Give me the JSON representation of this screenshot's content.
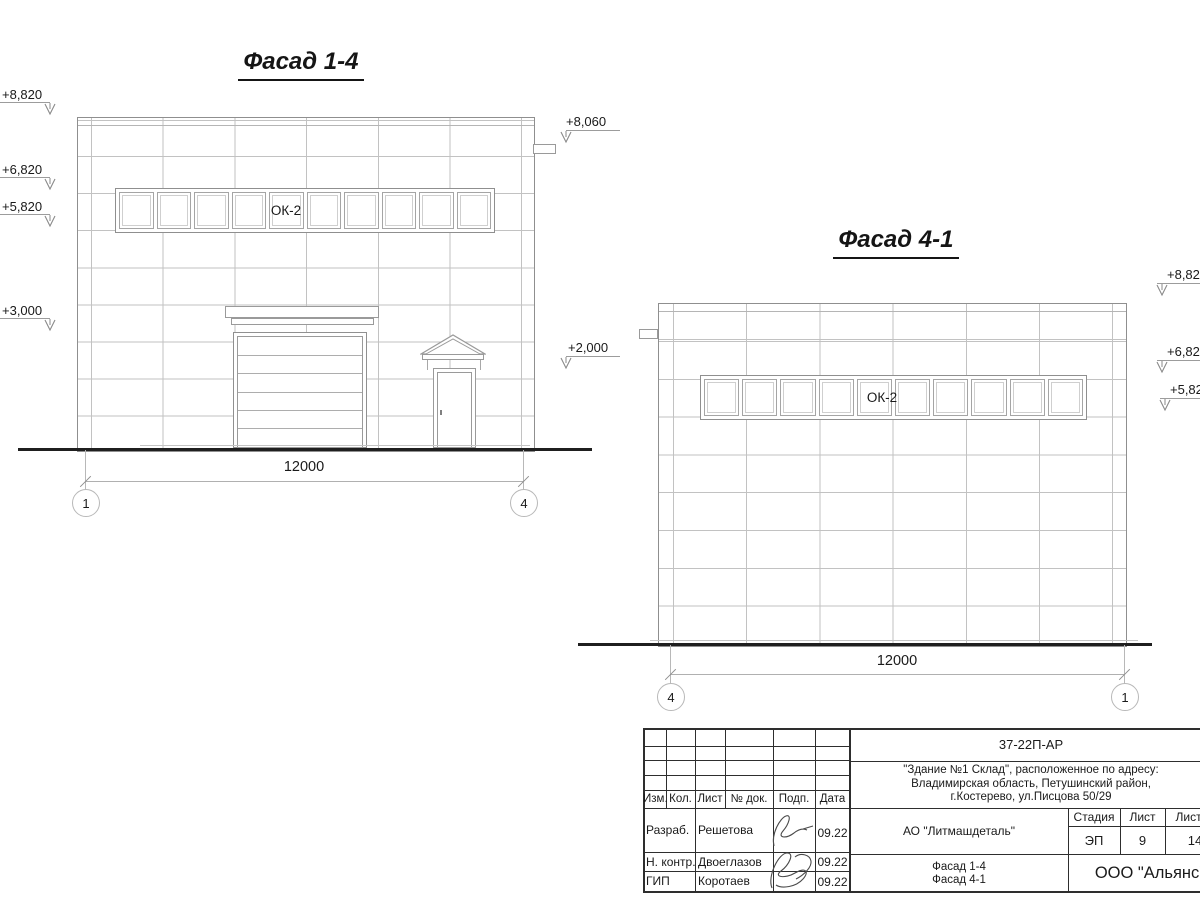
{
  "drawing": {
    "f14": {
      "title": "Фасад 1-4",
      "window_label": "ОК-2",
      "dim": "12000",
      "axis_start": "1",
      "axis_end": "4",
      "elev_8820": "+8,820",
      "elev_6820": "+6,820",
      "elev_5820": "+5,820",
      "elev_3000": "+3,000",
      "elev_8060": "+8,060",
      "elev_2000": "+2,000"
    },
    "f41": {
      "title": "Фасад 4-1",
      "window_label": "ОК-2",
      "dim": "12000",
      "axis_start": "4",
      "axis_end": "1",
      "elev_8820": "+8,820",
      "elev_6820": "+6,820",
      "elev_5820": "+5,820"
    }
  },
  "titleblock": {
    "doc_number": "37-22П-АР",
    "address1": "\"Здание №1 Склад\", расположенное по адресу:",
    "address2": "Владимирская область, Петушинский район,",
    "address3": "г.Костерево, ул.Писцова 50/29",
    "col_izm": "Изм.",
    "col_kol": "Кол.",
    "col_list": "Лист",
    "col_doc": "№ док.",
    "col_podp": "Подп.",
    "col_data": "Дата",
    "row1_role": "Разраб.",
    "row1_name": "Решетова",
    "row1_date": "09.22",
    "row2_role": "Н. контр.",
    "row2_name": "Двоеглазов",
    "row2_date": "09.22",
    "row3_role": "ГИП",
    "row3_name": "Коротаев",
    "row3_date": "09.22",
    "company": "АО \"Литмашдеталь\"",
    "stage_label": "Стадия",
    "sheet_label": "Лист",
    "sheets_label": "Листов",
    "stage": "ЭП",
    "sheet": "9",
    "sheets": "14",
    "subject1": "Фасад 1-4",
    "subject2": "Фасад 4-1",
    "org": "ООО \"Альянс\"",
    "colors": {
      "line": "#8f8f8f",
      "grid": "#c2c2c2",
      "ground": "#1f1f1f",
      "text": "#1a1a1a"
    }
  }
}
